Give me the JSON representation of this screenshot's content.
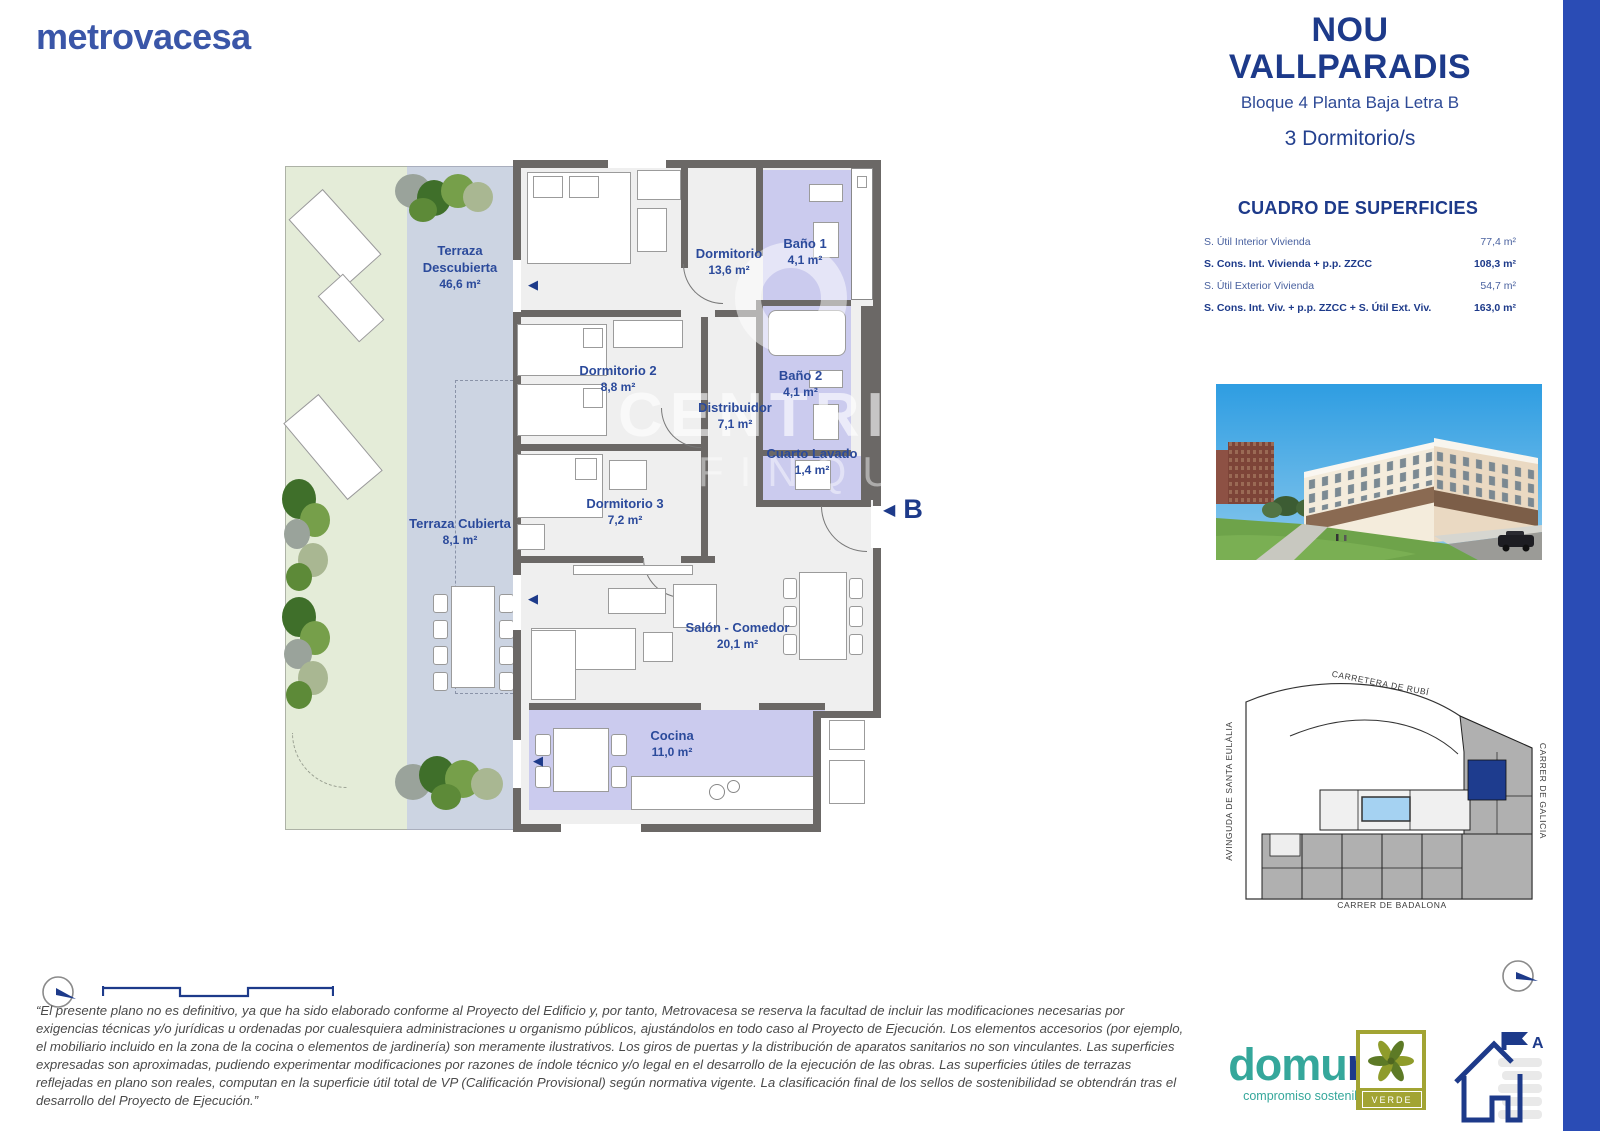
{
  "brand": {
    "logo_text": "metrovacesa"
  },
  "header": {
    "project_line1": "NOU",
    "project_line2": "VALLPARADIS",
    "unit": "Bloque 4 Planta Baja Letra B",
    "bedrooms": "3 Dormitorio/s"
  },
  "surfaces": {
    "title": "CUADRO DE SUPERFICIES",
    "rows": [
      {
        "label": "S. Útil Interior Vivienda",
        "value": "77,4 m²"
      },
      {
        "label": "S. Cons. Int. Vivienda + p.p. ZZCC",
        "value": "108,3 m²"
      },
      {
        "label": "S. Útil Exterior Vivienda",
        "value": "54,7 m²"
      },
      {
        "label": "S. Cons. Int. Viv. + p.p. ZZCC + S. Útil Ext. Viv.",
        "value": "163,0 m²"
      }
    ]
  },
  "floor_plan": {
    "entry_label": "B",
    "watermark_line1": "CENTRIC",
    "watermark_line2": "FINQUES",
    "terraces": [
      {
        "name": "Terraza Descubierta",
        "area": "46,6 m²"
      },
      {
        "name": "Terraza Cubierta",
        "area": "8,1 m²"
      }
    ],
    "rooms": [
      {
        "name": "Dormitorio",
        "area": "13,6 m²"
      },
      {
        "name": "Baño 1",
        "area": "4,1 m²"
      },
      {
        "name": "Dormitorio 2",
        "area": "8,8 m²"
      },
      {
        "name": "Baño 2",
        "area": "4,1 m²"
      },
      {
        "name": "Distribuidor",
        "area": "7,1 m²"
      },
      {
        "name": "Cuarto Lavado",
        "area": "1,4 m²"
      },
      {
        "name": "Dormitorio 3",
        "area": "7,2 m²"
      },
      {
        "name": "Salón - Comedor",
        "area": "20,1 m²"
      },
      {
        "name": "Cocina",
        "area": "11,0 m²"
      }
    ]
  },
  "site_map": {
    "street_top": "CARRETERA DE RUBÍ",
    "street_left": "AVINGUDA DE SANTA EULÀLIA",
    "street_right": "CARRER DE GALÍCIA",
    "street_bottom": "CARRER DE BADALONA"
  },
  "icons": {
    "window_marker": "◀"
  },
  "disclaimer": "“El presente plano no es definitivo, ya que ha sido elaborado conforme al Proyecto del Edificio y, por tanto, Metrovacesa se reserva la facultad de incluir las modificaciones necesarias por exigencias técnicas y/o jurídicas u ordenadas por cualesquiera administraciones u organismo públicos, ajustándolos en todo caso al Proyecto de Ejecución. Los elementos accesorios (por ejemplo, el mobiliario incluido en la zona de la cocina o elementos de jardinería) son meramente ilustrativos. Los giros de puertas y la distribución de aparatos sanitarios no son vinculantes. Las superficies expresadas son aproximadas, pudiendo experimentar modificaciones por razones de índole técnico y/o legal en el desarrollo de la ejecución de las obras. Las superficies útiles de terrazas reflejadas en plano son reales, computan en la superficie útil total de VP (Calificación Provisional) según normativa vigente. La clasificación final de los sellos de sostenibilidad se obtendrán tras el desarrollo del Proyecto de Ejecución.”",
  "footer": {
    "domum_part1": "domu",
    "domum_part2": "m",
    "domum_tagline": "compromiso sostenible",
    "verde_label": "VERDE",
    "energy_class": "A"
  },
  "colors": {
    "accent_navy": "#1d3a8a",
    "strip_blue": "#2a4cb5",
    "logo_blue": "#3a56a8"
  }
}
